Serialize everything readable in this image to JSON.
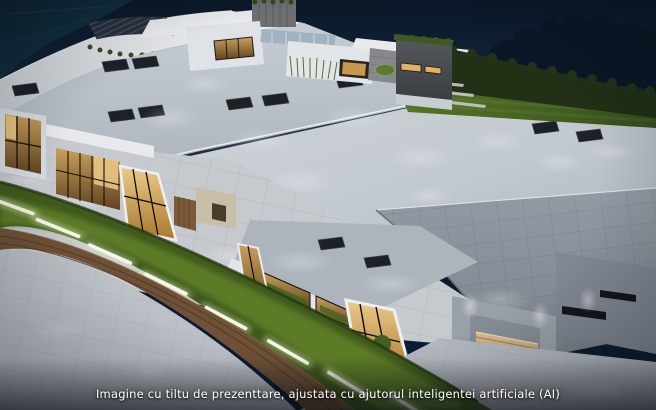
{
  "scene": {
    "alt": "Aerial night render of a modern flat-roof villa complex with lit interiors, rooftop skylights, hedges and an LED-lit lawn strip",
    "caption": "Imagine cu tiltu de prezenttare, ajustata cu ajutorul inteligentei artificiale (AI)"
  },
  "colors": {
    "sky_top": "#0a1828",
    "sky_bottom": "#17304a",
    "tree_silhouette": "#0a1726",
    "roof_bright": "#d2d7dc",
    "roof_mid": "#b3bac2",
    "roof_dark": "#8b929b",
    "skylight": "#1d2126",
    "hedge": "#223016",
    "lawn": "#4c6a20",
    "lawn_lit": "#64842a",
    "led_strip": "#f4f7e6",
    "window_warm": "#d9a95c",
    "wood_deck": "#c8a271",
    "wood_wall": "#6e5136",
    "pavement": "#c6cacf",
    "caption_text": "#ffffff"
  }
}
